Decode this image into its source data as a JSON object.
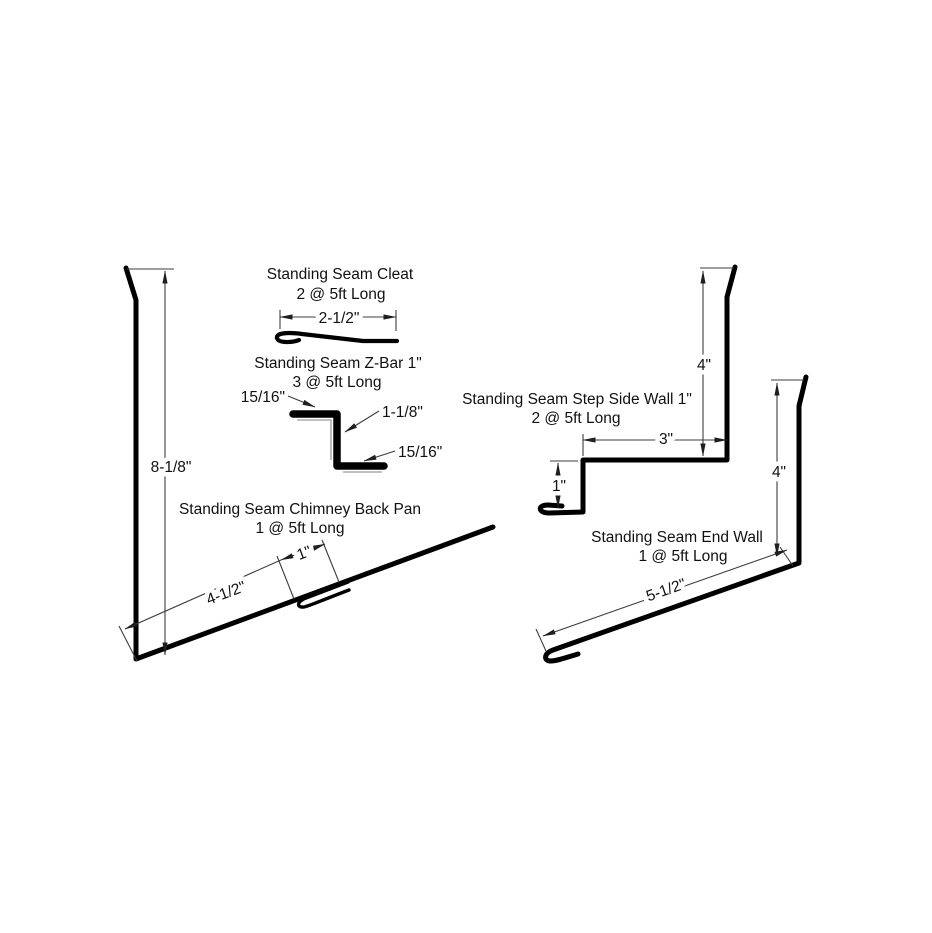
{
  "colors": {
    "line": "#000000",
    "dim": "#3c3c3c",
    "bg": "#ffffff",
    "inner": "#9a9a9a"
  },
  "drawings": {
    "cleat": {
      "title": "Standing Seam Cleat",
      "quantity": "2 @ 5ft Long",
      "dim_width": "2-1/2\""
    },
    "z_bar": {
      "title": "Standing Seam Z-Bar 1\"",
      "quantity": "3 @ 5ft Long",
      "dim_top_leg": "15/16\"",
      "dim_web": "1-1/8\"",
      "dim_bottom_leg": "15/16\""
    },
    "chimney_back_pan": {
      "title": "Standing Seam Chimney Back Pan",
      "quantity": "1 @ 5ft Long",
      "dim_height": "8-1/8\"",
      "dim_pan_width": "4-1/2\"",
      "dim_hem": "1\""
    },
    "step_side_wall": {
      "title": "Standing Seam Step Side Wall 1\"",
      "quantity": "2 @ 5ft Long",
      "dim_height": "4\"",
      "dim_top_width": "3\"",
      "dim_step": "1\""
    },
    "end_wall": {
      "title": "Standing Seam End Wall",
      "quantity": "1 @ 5ft Long",
      "dim_height": "4\"",
      "dim_pan_width": "5-1/2\""
    }
  }
}
